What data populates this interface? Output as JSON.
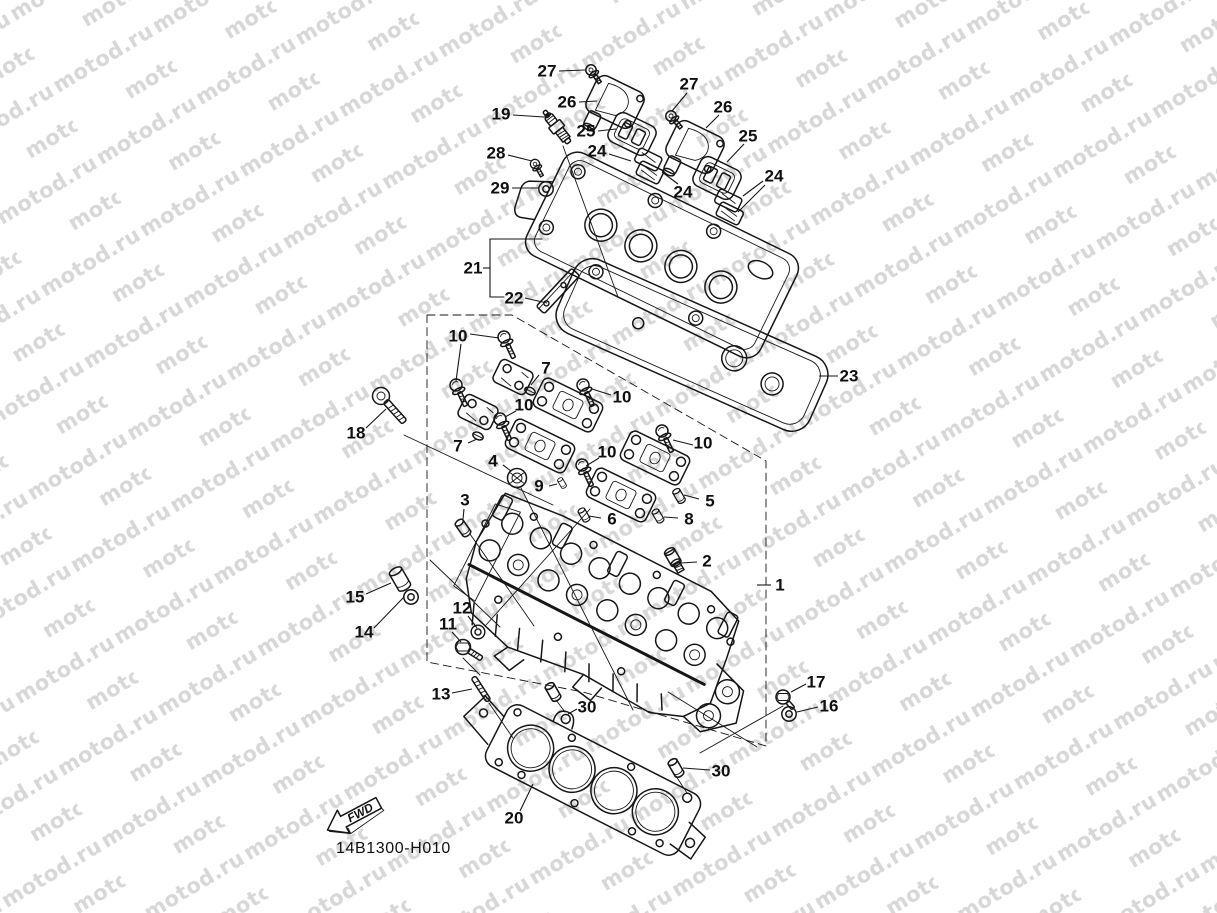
{
  "watermark": {
    "text": "motod.ru",
    "color": "#d7d7d7"
  },
  "drawing": {
    "code": "14B1300-H010",
    "fwd_label": "FWD",
    "line_color": "#161616",
    "background": "#ffffff"
  },
  "callouts": [
    {
      "label": "27",
      "x": 547,
      "y": 71,
      "leaders": [
        [
          559,
          71,
          585,
          70
        ]
      ]
    },
    {
      "label": "26",
      "x": 567,
      "y": 102,
      "leaders": [
        [
          579,
          102,
          597,
          101
        ]
      ]
    },
    {
      "label": "19",
      "x": 501,
      "y": 114,
      "leaders": [
        [
          513,
          115,
          544,
          117
        ]
      ]
    },
    {
      "label": "25",
      "x": 586,
      "y": 131,
      "leaders": [
        [
          598,
          131,
          616,
          129
        ]
      ]
    },
    {
      "label": "27",
      "x": 689,
      "y": 84,
      "leaders": [
        [
          687,
          93,
          672,
          111
        ]
      ]
    },
    {
      "label": "26",
      "x": 723,
      "y": 107,
      "leaders": [
        [
          719,
          115,
          706,
          128
        ]
      ]
    },
    {
      "label": "28",
      "x": 496,
      "y": 153,
      "leaders": [
        [
          508,
          155,
          532,
          161
        ]
      ]
    },
    {
      "label": "24",
      "x": 597,
      "y": 151,
      "leaders": [
        [
          609,
          154,
          631,
          161
        ]
      ]
    },
    {
      "label": "25",
      "x": 748,
      "y": 136,
      "leaders": [
        [
          744,
          144,
          727,
          162
        ]
      ]
    },
    {
      "label": "29",
      "x": 500,
      "y": 188,
      "leaders": [
        [
          512,
          188,
          539,
          188
        ]
      ]
    },
    {
      "label": "24",
      "x": 683,
      "y": 192,
      "leaders": [
        [
          678,
          184,
          662,
          172
        ]
      ]
    },
    {
      "label": "24",
      "x": 774,
      "y": 176,
      "leaders": [
        [
          763,
          181,
          743,
          196
        ],
        [
          765,
          185,
          738,
          212
        ]
      ]
    },
    {
      "label": "21",
      "x": 473,
      "y": 268,
      "leaders": [
        [
          483,
          268,
          490,
          268
        ]
      ]
    },
    {
      "label": "22",
      "x": 514,
      "y": 298,
      "leaders": [
        [
          525,
          298,
          547,
          303
        ]
      ]
    },
    {
      "label": "23",
      "x": 849,
      "y": 376,
      "leaders": [
        [
          838,
          376,
          819,
          376
        ]
      ]
    },
    {
      "label": "10",
      "x": 458,
      "y": 336,
      "leaders": [
        [
          470,
          334,
          499,
          338
        ],
        [
          461,
          344,
          456,
          381
        ]
      ]
    },
    {
      "label": "7",
      "x": 546,
      "y": 368,
      "leaders": [
        [
          539,
          375,
          531,
          385
        ]
      ]
    },
    {
      "label": "10",
      "x": 622,
      "y": 397,
      "leaders": [
        [
          611,
          395,
          592,
          389
        ]
      ]
    },
    {
      "label": "10",
      "x": 524,
      "y": 405,
      "leaders": [
        [
          516,
          411,
          505,
          417
        ]
      ]
    },
    {
      "label": "18",
      "x": 356,
      "y": 433,
      "leaders": [
        [
          366,
          428,
          386,
          409
        ]
      ]
    },
    {
      "label": "7",
      "x": 458,
      "y": 446,
      "leaders": [
        [
          468,
          443,
          477,
          439
        ]
      ]
    },
    {
      "label": "10",
      "x": 703,
      "y": 443,
      "leaders": [
        [
          693,
          445,
          673,
          440
        ]
      ]
    },
    {
      "label": "4",
      "x": 493,
      "y": 461,
      "leaders": [
        [
          503,
          465,
          511,
          471
        ]
      ]
    },
    {
      "label": "10",
      "x": 607,
      "y": 452,
      "leaders": [
        [
          599,
          458,
          586,
          466
        ]
      ]
    },
    {
      "label": "9",
      "x": 539,
      "y": 486,
      "leaders": [
        [
          549,
          486,
          557,
          484
        ]
      ]
    },
    {
      "label": "3",
      "x": 465,
      "y": 500,
      "leaders": [
        [
          464,
          509,
          463,
          519
        ]
      ]
    },
    {
      "label": "5",
      "x": 710,
      "y": 501,
      "leaders": [
        [
          699,
          499,
          684,
          495
        ]
      ]
    },
    {
      "label": "6",
      "x": 612,
      "y": 519,
      "leaders": [
        [
          601,
          518,
          589,
          516
        ]
      ]
    },
    {
      "label": "8",
      "x": 689,
      "y": 519,
      "leaders": [
        [
          678,
          518,
          664,
          517
        ]
      ]
    },
    {
      "label": "2",
      "x": 707,
      "y": 561,
      "leaders": [
        [
          697,
          562,
          681,
          563
        ]
      ]
    },
    {
      "label": "1",
      "x": 780,
      "y": 585,
      "leaders": [
        [
          771,
          585,
          757,
          585
        ]
      ]
    },
    {
      "label": "15",
      "x": 355,
      "y": 597,
      "leaders": [
        [
          366,
          594,
          391,
          583
        ]
      ]
    },
    {
      "label": "14",
      "x": 364,
      "y": 632,
      "leaders": [
        [
          374,
          628,
          404,
          597
        ]
      ]
    },
    {
      "label": "12",
      "x": 462,
      "y": 608,
      "leaders": [
        [
          468,
          616,
          477,
          628
        ]
      ]
    },
    {
      "label": "11",
      "x": 448,
      "y": 624,
      "leaders": [
        [
          452,
          632,
          461,
          642
        ]
      ]
    },
    {
      "label": "13",
      "x": 441,
      "y": 694,
      "leaders": [
        [
          452,
          693,
          472,
          689
        ]
      ]
    },
    {
      "label": "30",
      "x": 587,
      "y": 707,
      "leaders": [
        [
          577,
          709,
          568,
          714
        ]
      ]
    },
    {
      "label": "17",
      "x": 816,
      "y": 682,
      "leaders": [
        [
          806,
          684,
          791,
          692
        ]
      ]
    },
    {
      "label": "16",
      "x": 829,
      "y": 706,
      "leaders": [
        [
          818,
          707,
          797,
          712
        ]
      ]
    },
    {
      "label": "30",
      "x": 721,
      "y": 771,
      "leaders": [
        [
          710,
          770,
          683,
          768
        ]
      ]
    },
    {
      "label": "20",
      "x": 514,
      "y": 818,
      "leaders": [
        [
          520,
          811,
          533,
          784
        ]
      ]
    }
  ]
}
